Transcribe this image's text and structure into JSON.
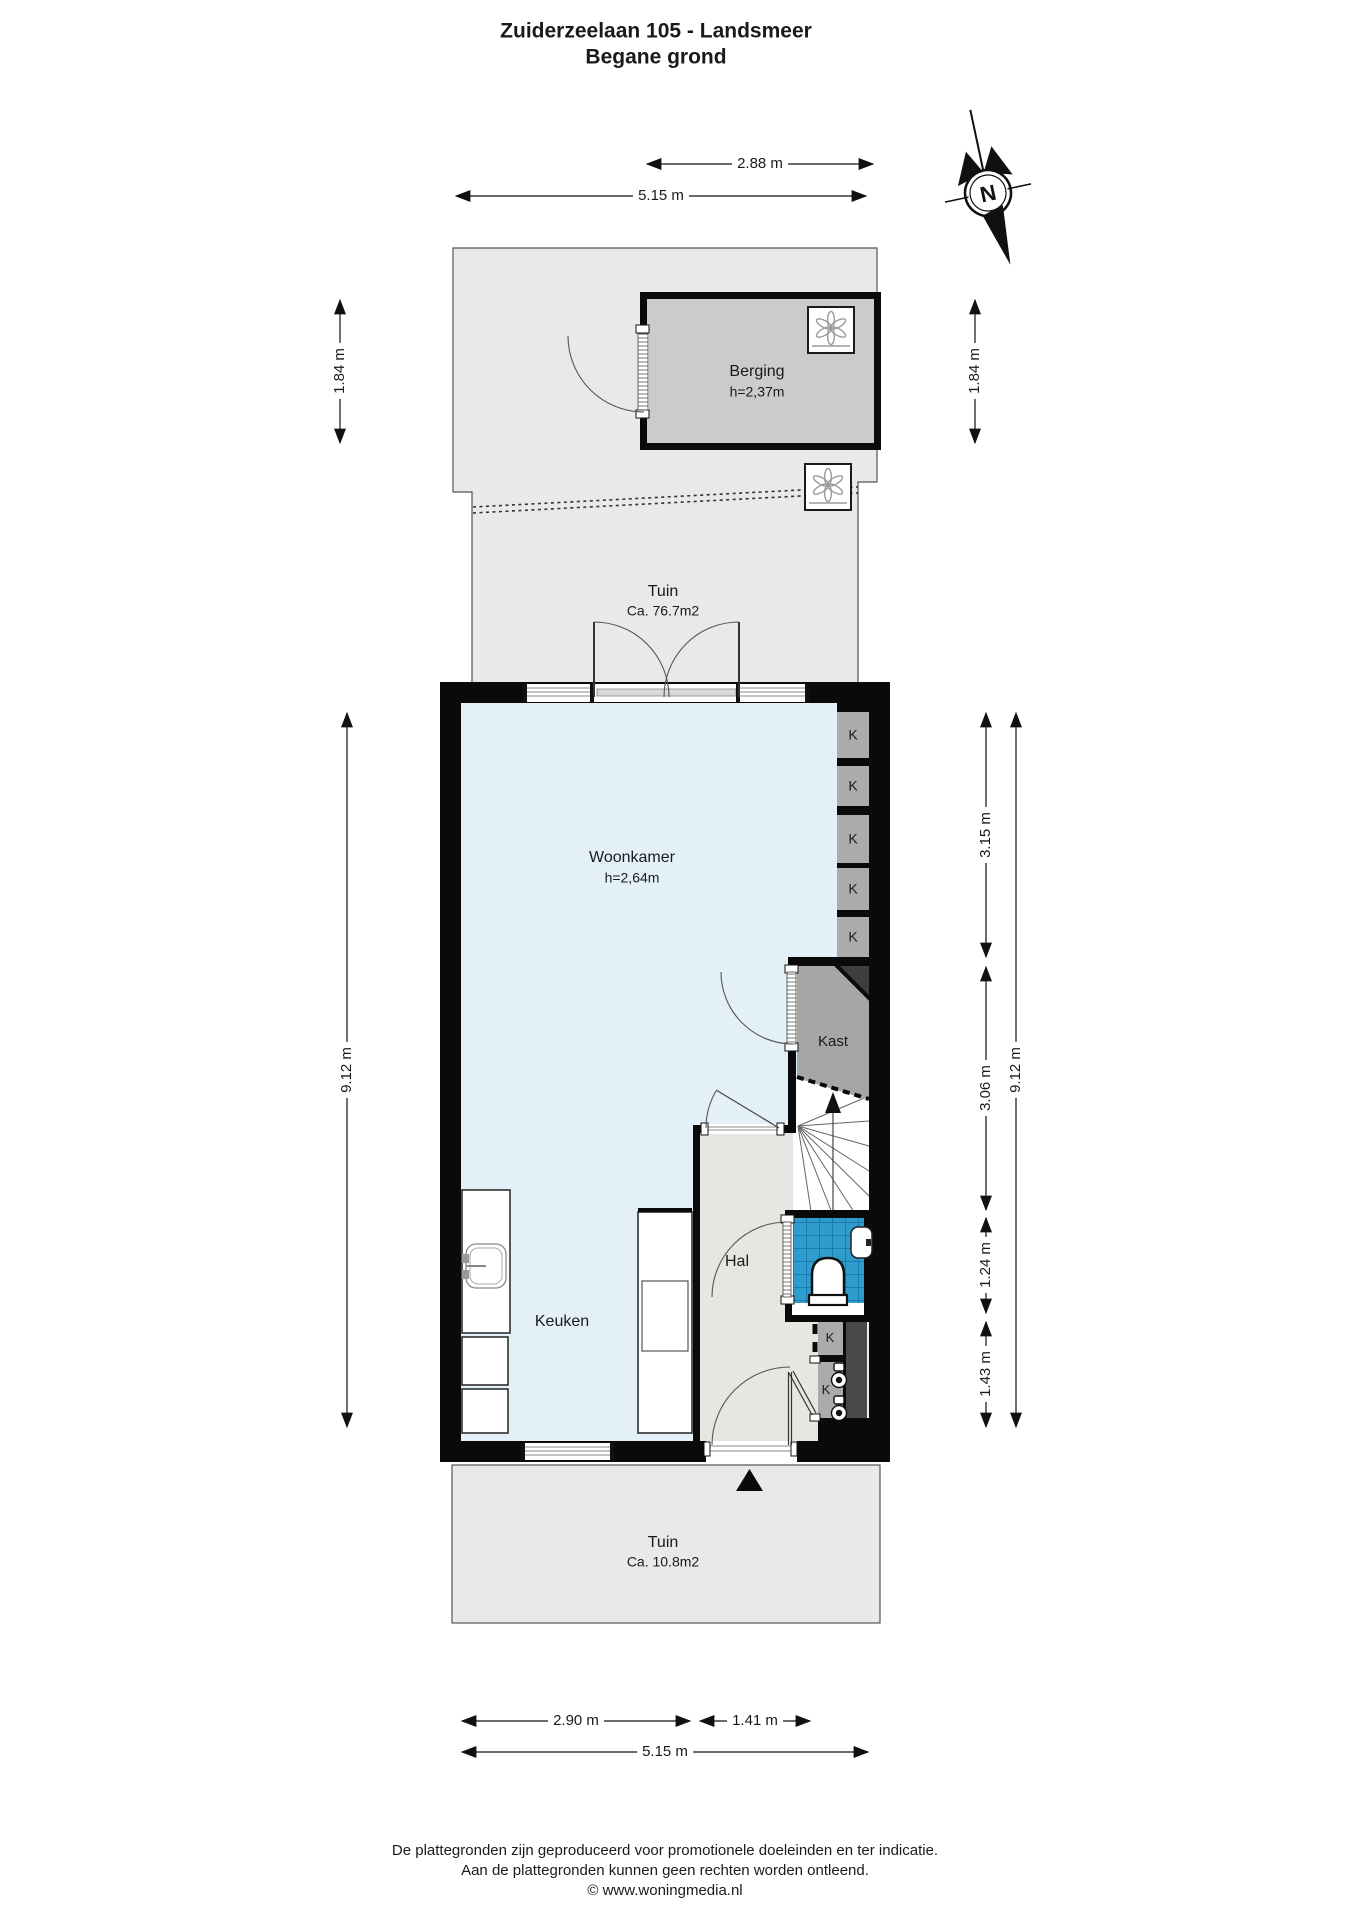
{
  "title": {
    "line1": "Zuiderzeelaan 105 - Landsmeer",
    "line2": "Begane grond"
  },
  "compass": {
    "north": "N"
  },
  "rooms": {
    "berging": {
      "name": "Berging",
      "height": "h=2,37m"
    },
    "tuin_top": {
      "name": "Tuin",
      "area": "Ca. 76.7m2"
    },
    "woonkamer": {
      "name": "Woonkamer",
      "height": "h=2,64m"
    },
    "kast": {
      "name": "Kast"
    },
    "hal": {
      "name": "Hal"
    },
    "keuken": {
      "name": "Keuken"
    },
    "tuin_bottom": {
      "name": "Tuin",
      "area": "Ca. 10.8m2"
    },
    "k_label": "K"
  },
  "dimensions": {
    "top_288": "2.88 m",
    "top_515": "5.15 m",
    "left_184": "1.84 m",
    "right_184": "1.84 m",
    "left_912": "9.12 m",
    "right_315": "3.15 m",
    "right_306": "3.06 m",
    "right_124": "1.24 m",
    "right_143": "1.43 m",
    "right_912": "9.12 m",
    "bottom_290": "2.90 m",
    "bottom_141": "1.41 m",
    "bottom_515": "5.15 m"
  },
  "footer": {
    "line1": "De plattegronden zijn geproduceerd voor promotionele doeleinden en ter indicatie.",
    "line2": "Aan de plattegronden kunnen geen rechten worden ontleend.",
    "line3": "© www.woningmedia.nl"
  },
  "colors": {
    "wall": "#0a0a0a",
    "floor_living": "#e3f0f7",
    "floor_hall": "#e7e6e2",
    "floor_garden": "#e9e9e9",
    "floor_storage": "#cbcbcb",
    "closet_gray": "#a8a8a8",
    "shaft_dark": "#4a4a4a",
    "tile_blue": "#2e9ccd"
  }
}
